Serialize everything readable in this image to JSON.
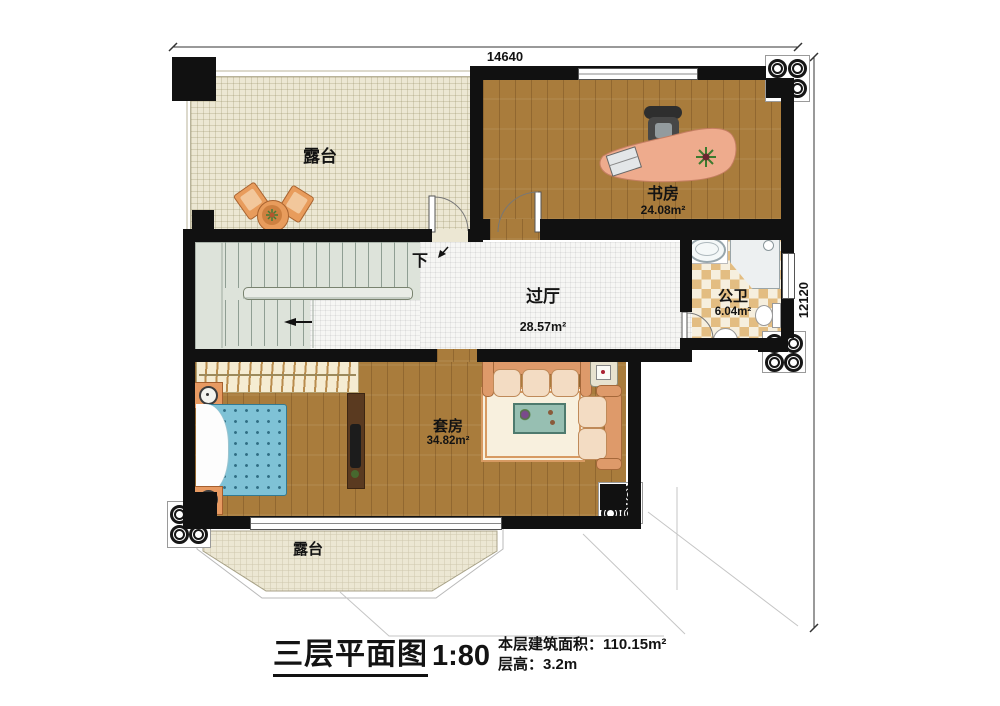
{
  "dimensions": {
    "top": "14640",
    "right": "12120"
  },
  "rooms": {
    "terrace_top": {
      "name": "露台"
    },
    "study": {
      "name": "书房",
      "area": "24.08m²"
    },
    "bathroom": {
      "name": "公卫",
      "area": "6.04m²"
    },
    "hall": {
      "name": "过厅",
      "area": "28.57m²"
    },
    "suite": {
      "name": "套房",
      "area": "34.82m²"
    },
    "terrace_bottom": {
      "name": "露台"
    }
  },
  "stairs": {
    "direction_label": "下"
  },
  "title_block": {
    "title": "三层平面图",
    "scale": "1:80",
    "area_label": "本层建筑面积：",
    "area_value": "110.15m²",
    "height_label": "层高：",
    "height_value": "3.2m"
  },
  "colors": {
    "wall": "#111111",
    "wood_floor": "#a97c3c",
    "terrace_floor": "#ece7d3",
    "bath_tile": "#e3bd82",
    "stair_floor": "#dde3da",
    "desk": "#eeab8d",
    "bed": "#7fc2d6",
    "sofa": "#de9a6a"
  }
}
